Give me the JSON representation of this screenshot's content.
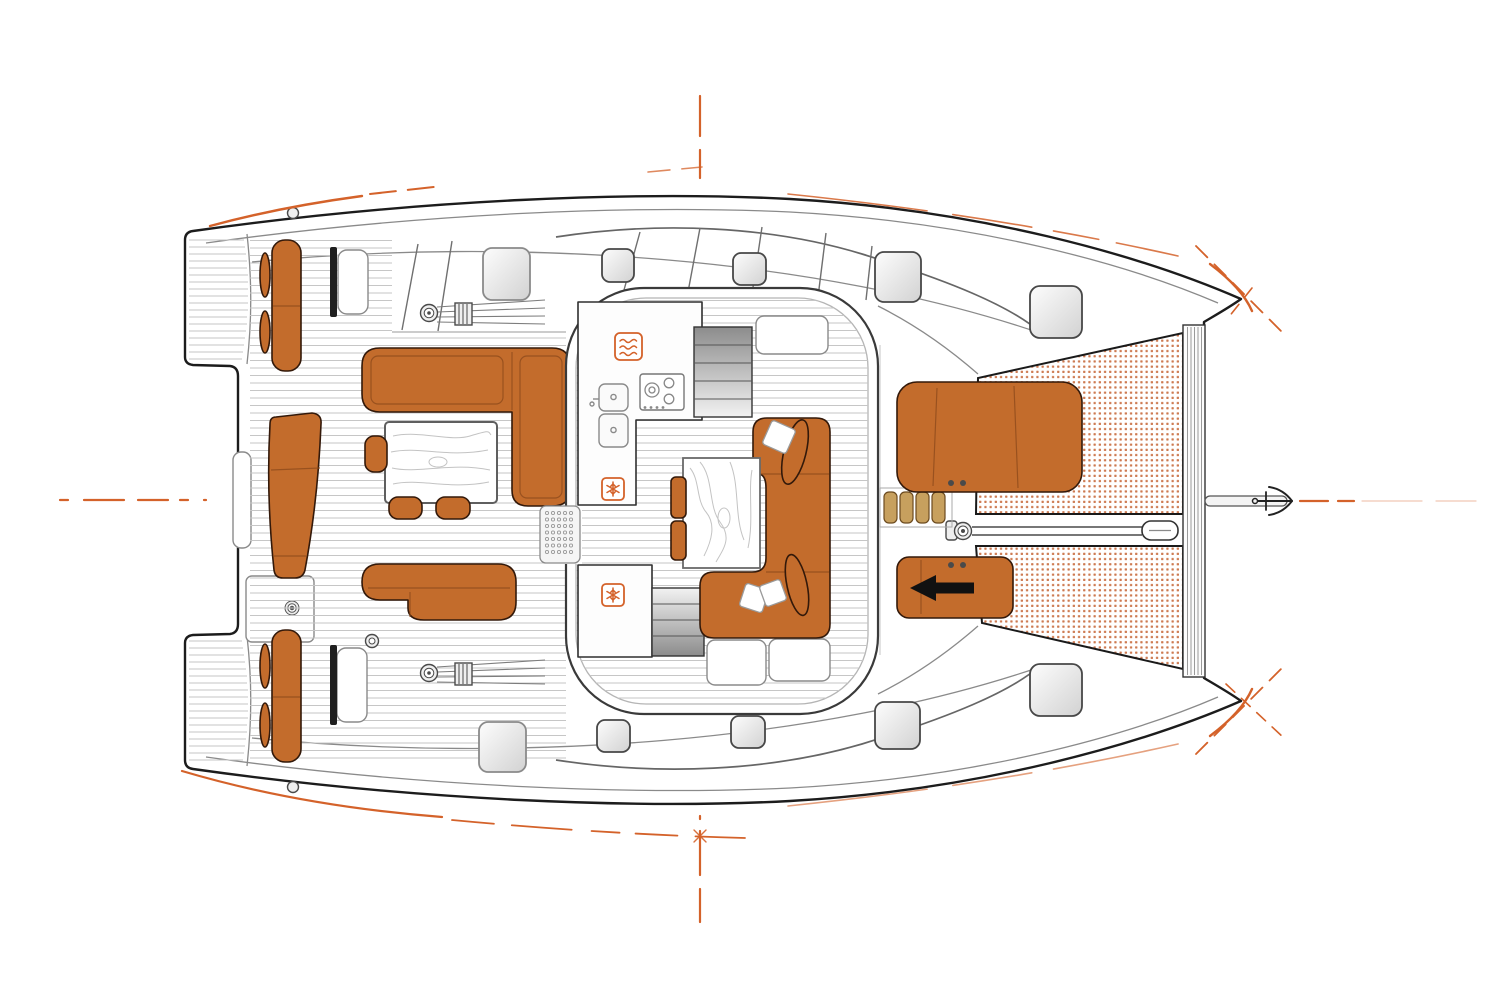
{
  "meta": {
    "title": "Catamaran deck plan, top view, bow facing right",
    "drawing_type": "technical-illustration",
    "visible_text": "none"
  },
  "palette": {
    "white": "#ffffff",
    "outline": "#1c1c1c",
    "dark": "#1f1f1f",
    "line": "#8a8a8a",
    "mid_gray": "#b5b5b5",
    "plank": "#c6c6c6",
    "upholstery": "#c36c2c",
    "upholstery_seam": "#8f4b1c",
    "upholstery_edge": "#33190a",
    "accent": "#d4622a",
    "tramp_dot": "#c25d2b",
    "wood": "#c7a05e",
    "wood_edge": "#6b4a1f",
    "hatch_hi": "#fdfdfd",
    "hatch_lo": "#d2d2d2",
    "hatch_edge": "#474747",
    "stair_dark": "#8c8c8c",
    "stair_light": "#f2f2f2"
  },
  "regions": {
    "stern_label": "aft cockpit with swim platforms",
    "saloon_label": "saloon with galley and dining area",
    "foredeck_label": "foredeck with sunpads, trampolines and anchor gear"
  },
  "components": {
    "cockpit": [
      "transom-step-fans",
      "aft-bench-port",
      "aft-bench-starboard",
      "aft-center-bench",
      "cockpit-l-sofa",
      "cockpit-bench-sofa",
      "cockpit-table",
      "stools",
      "helm-consoles",
      "winches-and-lines"
    ],
    "saloon": [
      "galley-counter",
      "cooktop",
      "double-sink",
      "waves-icon",
      "snowflake-icon-x2",
      "hull-stairs-x2",
      "entry-mat",
      "dining-table",
      "c-shaped-sofa",
      "pillows",
      "sideboard"
    ],
    "foredeck": [
      "sunpad-large",
      "sunpad-sliding-with-arrow",
      "teak-steps",
      "windlass",
      "anchor-chain",
      "bow-roller",
      "forward-crossbeam",
      "trampoline-port",
      "trampoline-starboard",
      "bowsprit-anchor"
    ],
    "marks": [
      "centerline-dashes",
      "sheerline-accents",
      "bow-cross-marks",
      "deck-hatches-x10"
    ]
  },
  "icons": [
    {
      "name": "waves-icon",
      "meaning_shown_as": "rounded square with three wavy lines"
    },
    {
      "name": "snowflake-icon",
      "meaning_shown_as": "rounded square with snowflake",
      "count": 2
    },
    {
      "name": "anchor-icon",
      "meaning_shown_as": "anchor glyph at bowsprit tip"
    },
    {
      "name": "arrow-icon",
      "meaning_shown_as": "black arrow pointing aft on sliding pad"
    }
  ]
}
